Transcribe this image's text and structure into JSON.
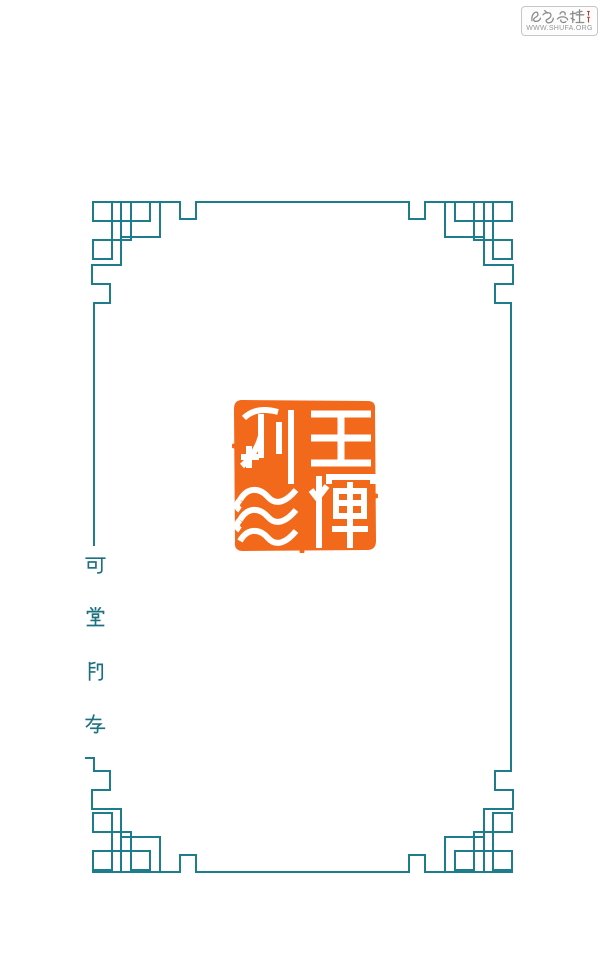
{
  "page": {
    "width": 605,
    "height": 964,
    "background": "#ffffff",
    "kind": "seal catalog scan"
  },
  "watermark": {
    "brand": "书艺公社",
    "url": "WWW.SHUFA.ORG"
  },
  "frame": {
    "description": "teal fret-pattern border with interlocking corner squares",
    "color": "#1e7d8d"
  },
  "seal": {
    "reading": "王煇利印",
    "columns": {
      "right": [
        "王",
        "煇"
      ],
      "left": [
        "利",
        "印"
      ]
    },
    "bg_color": "#f2691b",
    "glyph_color": "#ffffff"
  },
  "caption": {
    "text": "可堂印存",
    "chars": [
      "可",
      "堂",
      "印",
      "存"
    ],
    "color": "#1d7080"
  },
  "theme": {
    "frame-color": "#1e7d8d",
    "caption-color": "#1d7080",
    "seal-bg": "#f2691b",
    "seal-glyph": "#ffffff",
    "wm-gray": "#8a8a8a",
    "wm-url-gray": "#97989a",
    "wm-border": "#c6c6c6",
    "wm-red": "#c0392b"
  }
}
